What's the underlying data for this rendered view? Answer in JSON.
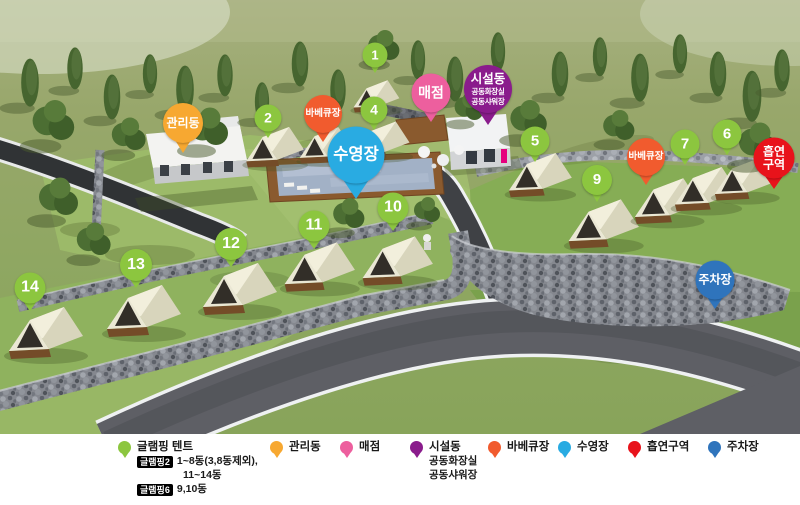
{
  "map": {
    "tent_pin_color": "#8CC63F",
    "tent_pins": [
      {
        "label": "1",
        "x": 375,
        "y": 55,
        "size": 25
      },
      {
        "label": "2",
        "x": 268,
        "y": 118,
        "size": 27
      },
      {
        "label": "4",
        "x": 374,
        "y": 110,
        "size": 27
      },
      {
        "label": "5",
        "x": 535,
        "y": 141,
        "size": 29
      },
      {
        "label": "6",
        "x": 727,
        "y": 134,
        "size": 29
      },
      {
        "label": "7",
        "x": 685,
        "y": 144,
        "size": 29
      },
      {
        "label": "9",
        "x": 597,
        "y": 180,
        "size": 30
      },
      {
        "label": "10",
        "x": 393,
        "y": 208,
        "size": 31
      },
      {
        "label": "11",
        "x": 314,
        "y": 226,
        "size": 31
      },
      {
        "label": "12",
        "x": 231,
        "y": 244,
        "size": 32
      },
      {
        "label": "13",
        "x": 136,
        "y": 265,
        "size": 32
      },
      {
        "label": "14",
        "x": 30,
        "y": 288,
        "size": 31
      }
    ],
    "facility_pins": [
      {
        "id": "management",
        "label": "관리동",
        "x": 183,
        "y": 123,
        "size": 40,
        "color": "#F7A831",
        "font": 12
      },
      {
        "id": "bbq-1",
        "label": "바베큐장",
        "x": 323,
        "y": 114,
        "size": 38,
        "color": "#F15B2E",
        "font": 9.5
      },
      {
        "id": "store",
        "label": "매점",
        "x": 431,
        "y": 93,
        "size": 39,
        "color": "#ED5F9E",
        "font": 14
      },
      {
        "id": "facility",
        "label": "시설동",
        "sub": [
          "공동화장실",
          "공동샤워장"
        ],
        "x": 488,
        "y": 89,
        "size": 48,
        "color": "#8A1C8C",
        "font": 12.5
      },
      {
        "id": "pool",
        "label": "수영장",
        "x": 356,
        "y": 155,
        "size": 57,
        "color": "#29ABE2",
        "font": 16.5
      },
      {
        "id": "bbq-2",
        "label": "바베큐장",
        "x": 646,
        "y": 157,
        "size": 38,
        "color": "#F15B2E",
        "font": 9.5
      },
      {
        "id": "smoking",
        "lines": [
          "흡연",
          "구역"
        ],
        "x": 774,
        "y": 158,
        "size": 41,
        "color": "#E8131B",
        "font": 12
      },
      {
        "id": "parking",
        "label": "주차장",
        "x": 715,
        "y": 280,
        "size": 39,
        "color": "#2F74BC",
        "font": 12
      }
    ]
  },
  "legend": {
    "items": [
      {
        "id": "glamping-tent",
        "label": "글램핑 텐트",
        "color": "#8CC63F",
        "notes": [
          {
            "badge": "글램핑2",
            "text": "1~8동(3,8동제외),"
          },
          {
            "badge": "",
            "text": "11~14동"
          },
          {
            "badge": "글램핑6",
            "text": "9,10동"
          }
        ]
      },
      {
        "id": "management",
        "label": "관리동",
        "color": "#F7A831"
      },
      {
        "id": "store",
        "label": "매점",
        "color": "#ED5F9E"
      },
      {
        "id": "facility",
        "label": "시설동",
        "color": "#8A1C8C",
        "sublines": [
          "공동화장실",
          "공동샤워장"
        ]
      },
      {
        "id": "bbq",
        "label": "바베큐장",
        "color": "#F15B2E"
      },
      {
        "id": "pool",
        "label": "수영장",
        "color": "#29ABE2"
      },
      {
        "id": "smoking",
        "label": "흡연구역",
        "color": "#E8131B"
      },
      {
        "id": "parking",
        "label": "주차장",
        "color": "#2F74BC"
      }
    ]
  }
}
